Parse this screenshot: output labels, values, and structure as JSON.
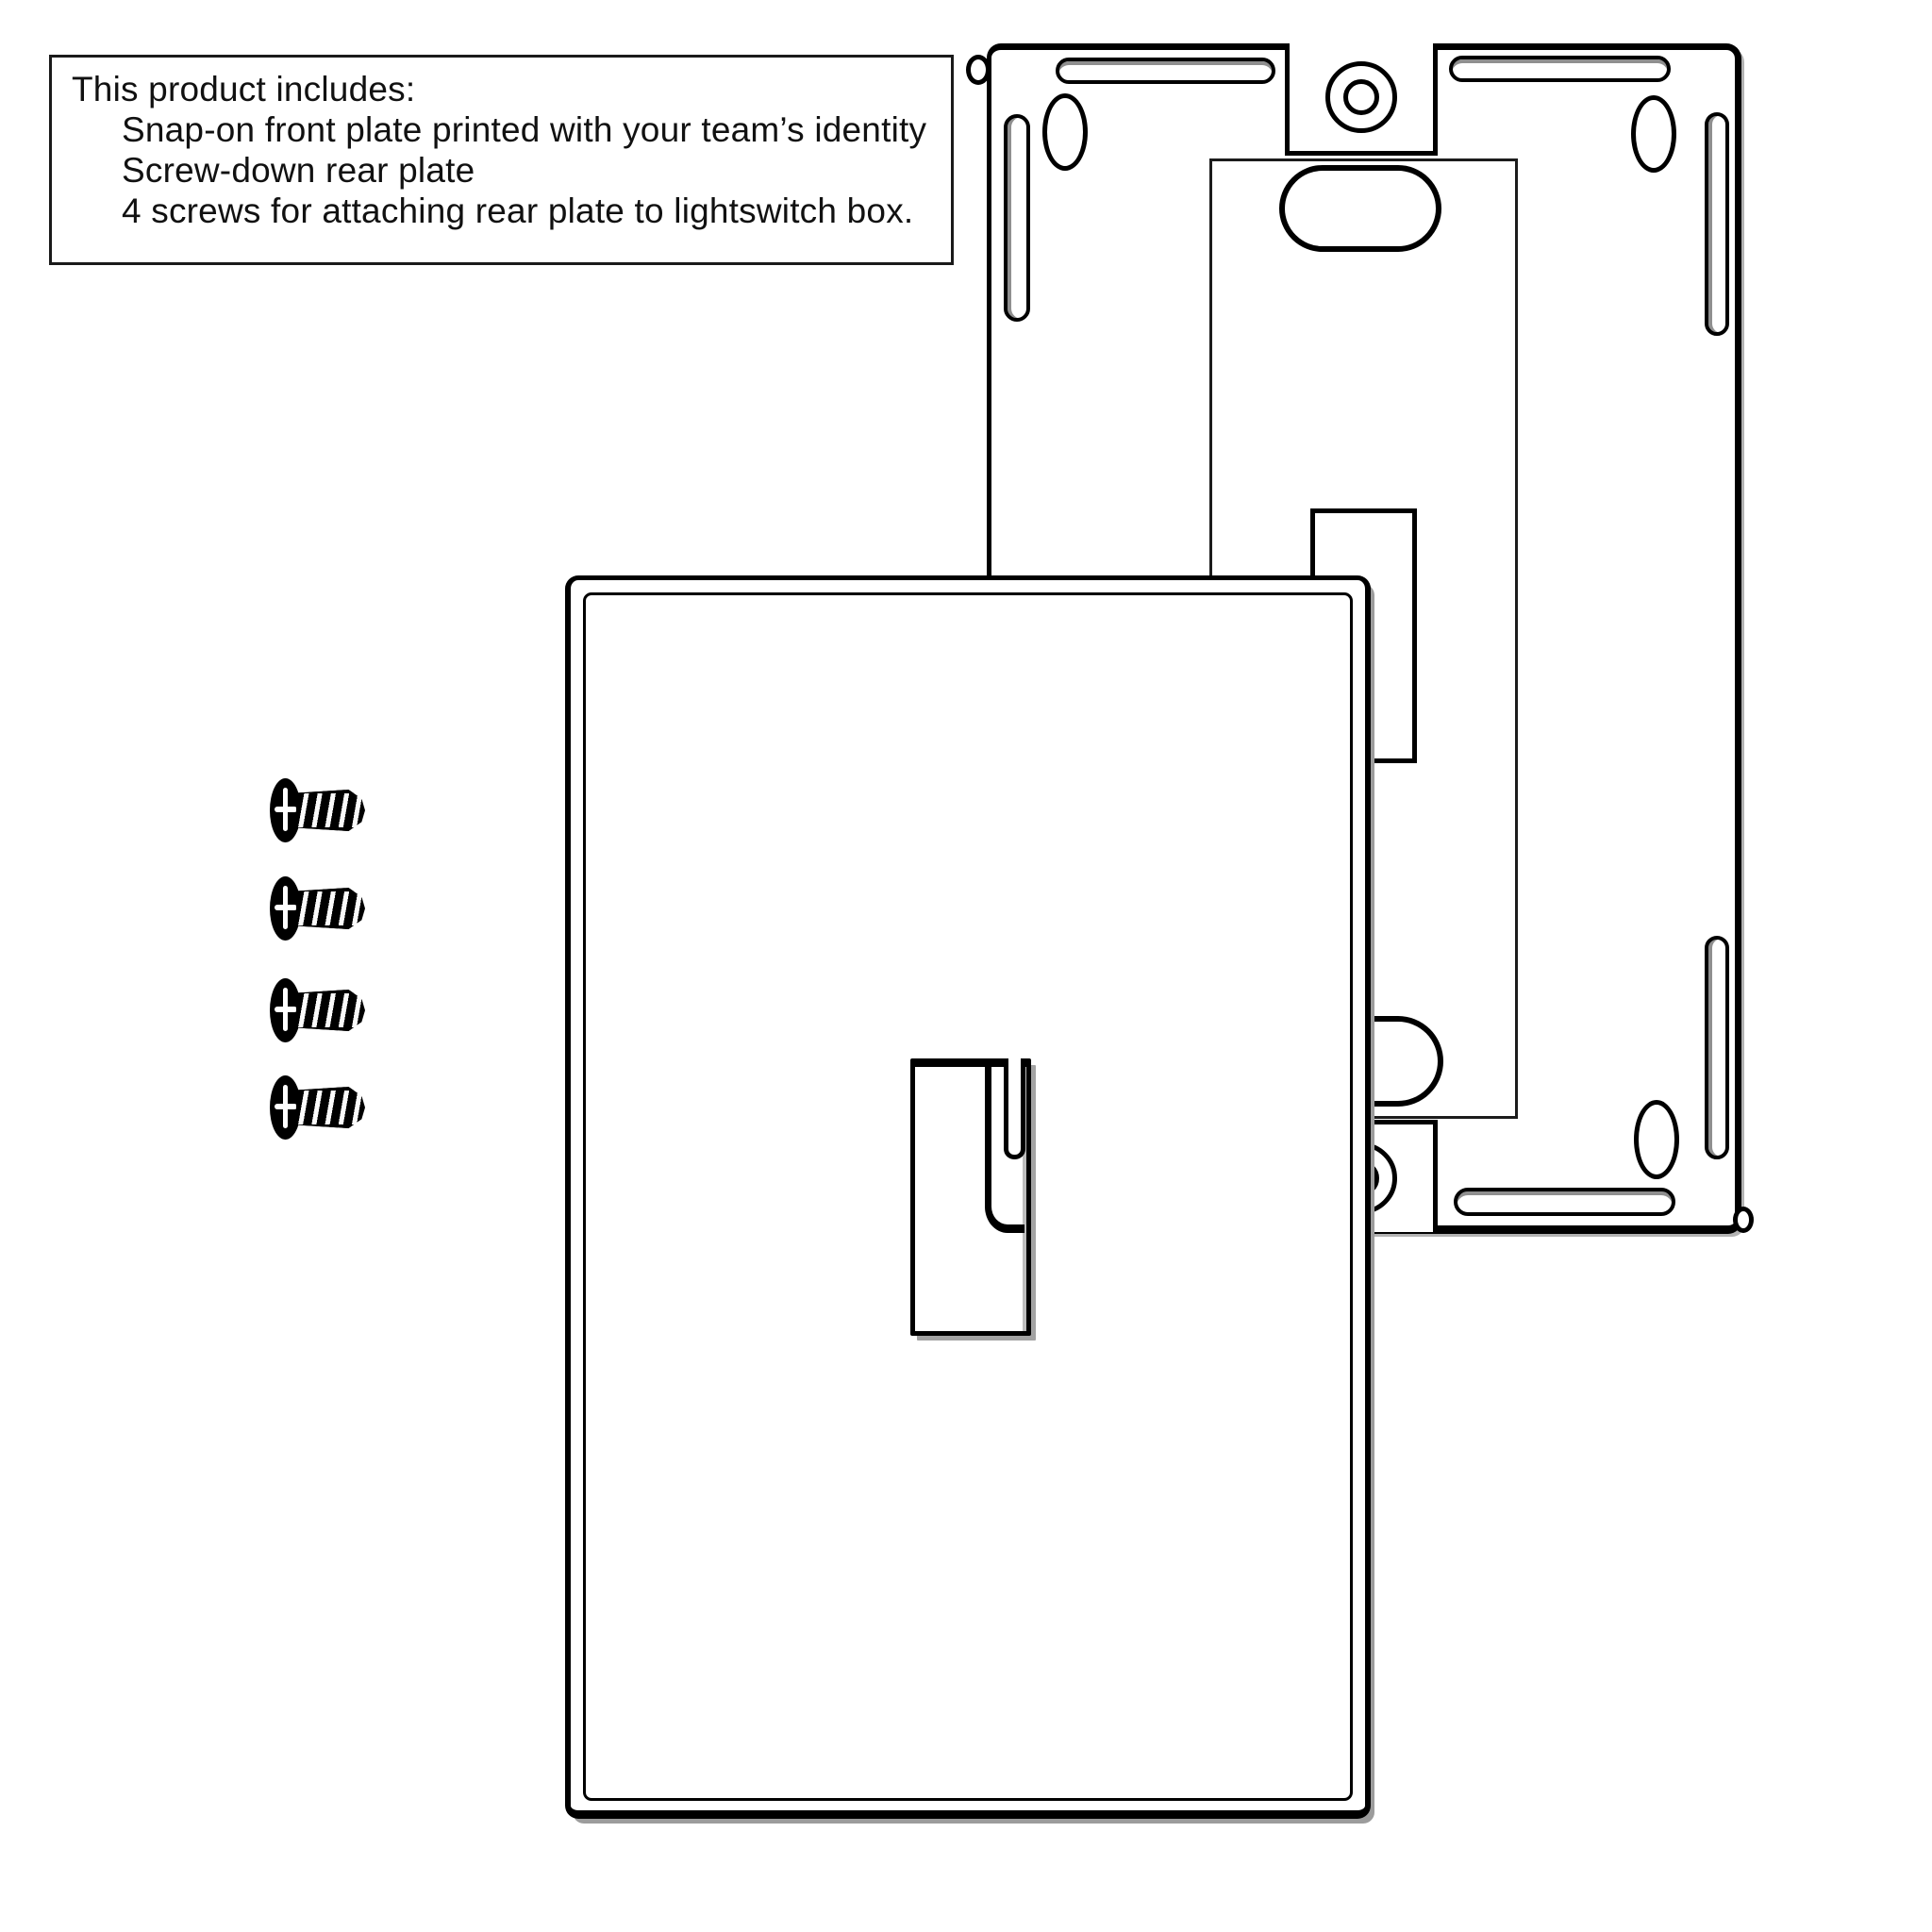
{
  "info_box": {
    "title": "This product includes:",
    "items": [
      "Snap-on front plate printed with your team’s identity",
      "Screw-down rear plate",
      "4 screws for attaching rear plate to lightswitch box."
    ]
  },
  "diagram": {
    "parts": [
      "front-plate",
      "rear-plate",
      "screws"
    ],
    "screw_count": 4
  },
  "colors": {
    "background": "#ffffff",
    "line": "#000000",
    "shadow_gray": "#9c9c9c"
  }
}
